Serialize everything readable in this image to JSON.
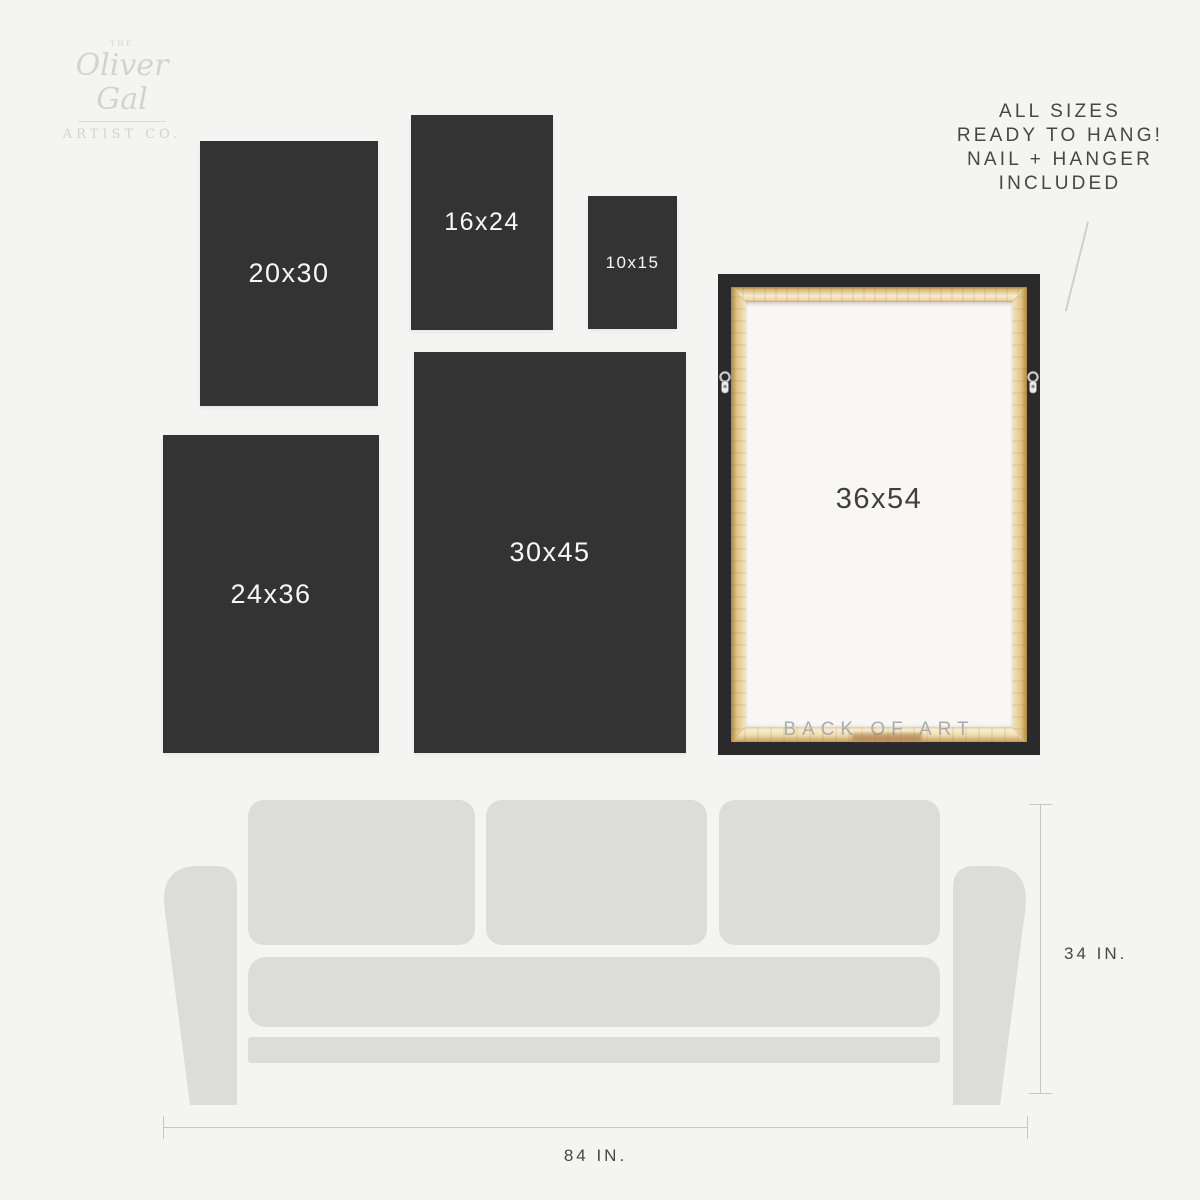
{
  "colors": {
    "background": "#f4f4f3",
    "panel": "#333333",
    "panel_text": "#f7f7f7",
    "couch": "#dcdcdb",
    "frame_black": "#2a2a2a",
    "canvas": "#f8f7f6",
    "text_dark": "#474747",
    "muted_text": "#ababab",
    "logo_gray": "#d2d2d1",
    "dim_line": "#c6c6c5"
  },
  "logo": {
    "the": "THE",
    "name": "Oliver Gal",
    "subtitle": "ARTIST CO."
  },
  "note": {
    "line1": "ALL SIZES",
    "line2": "READY TO HANG!",
    "line3": "NAIL + HANGER",
    "line4": "INCLUDED"
  },
  "sizes": [
    {
      "label": "20x30"
    },
    {
      "label": "16x24"
    },
    {
      "label": "10x15"
    },
    {
      "label": "24x36"
    },
    {
      "label": "30x45"
    }
  ],
  "frame": {
    "label": "36x54",
    "back_label": "BACK OF ART"
  },
  "dimensions": {
    "couch_width": "84 IN.",
    "couch_height": "34 IN."
  }
}
